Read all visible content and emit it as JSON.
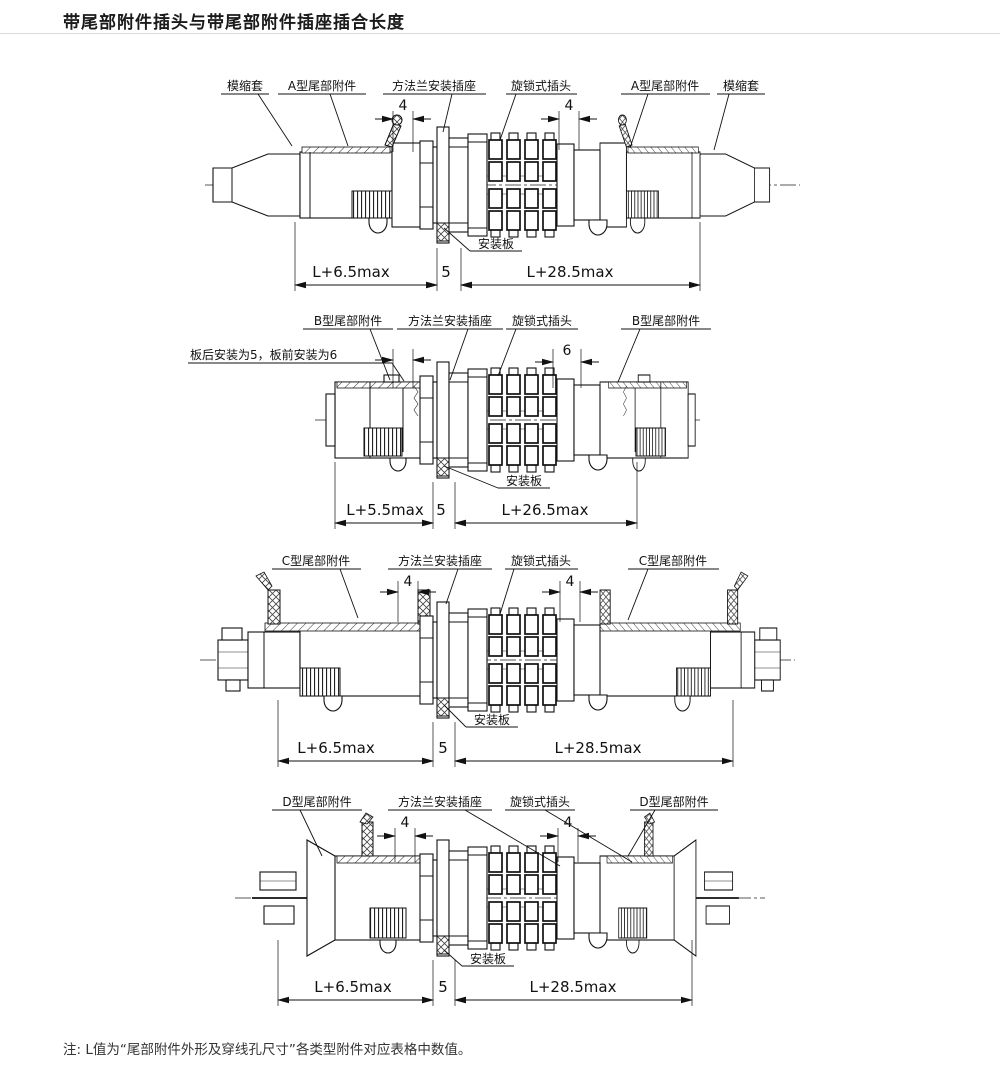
{
  "page": {
    "title": "带尾部附件插头与带尾部附件插座插合长度",
    "note": "注: L值为“尾部附件外形及穿线孔尺寸”各类型附件对应表格中数值。"
  },
  "diagrams": [
    {
      "type": "A",
      "labels": {
        "left_sleeve": "模缩套",
        "left_tail": "A型尾部附件",
        "socket": "方法兰安装插座",
        "plug": "旋锁式插头",
        "right_tail": "A型尾部附件",
        "right_sleeve": "模缩套",
        "plate": "安装板"
      },
      "dims": {
        "small_left": "4",
        "small_right": "4",
        "left": "L+6.5max",
        "mid": "5",
        "right": "L+28.5max"
      }
    },
    {
      "type": "B",
      "labels": {
        "left_tail": "B型尾部附件",
        "socket": "方法兰安装插座",
        "plug": "旋锁式插头",
        "right_tail": "B型尾部附件",
        "plate": "安装板",
        "install_note": "板后安装为5，板前安装为6"
      },
      "dims": {
        "small_right": "6",
        "left": "L+5.5max",
        "mid": "5",
        "right": "L+26.5max"
      }
    },
    {
      "type": "C",
      "labels": {
        "left_tail": "C型尾部附件",
        "socket": "方法兰安装插座",
        "plug": "旋锁式插头",
        "right_tail": "C型尾部附件",
        "plate": "安装板"
      },
      "dims": {
        "small_left": "4",
        "small_right": "4",
        "left": "L+6.5max",
        "mid": "5",
        "right": "L+28.5max"
      }
    },
    {
      "type": "D",
      "labels": {
        "left_tail": "D型尾部附件",
        "socket": "方法兰安装插座",
        "plug": "旋锁式插头",
        "right_tail": "D型尾部附件",
        "plate": "安装板"
      },
      "dims": {
        "small_left": "4",
        "small_right": "4",
        "left": "L+6.5max",
        "mid": "5",
        "right": "L+28.5max"
      }
    }
  ]
}
